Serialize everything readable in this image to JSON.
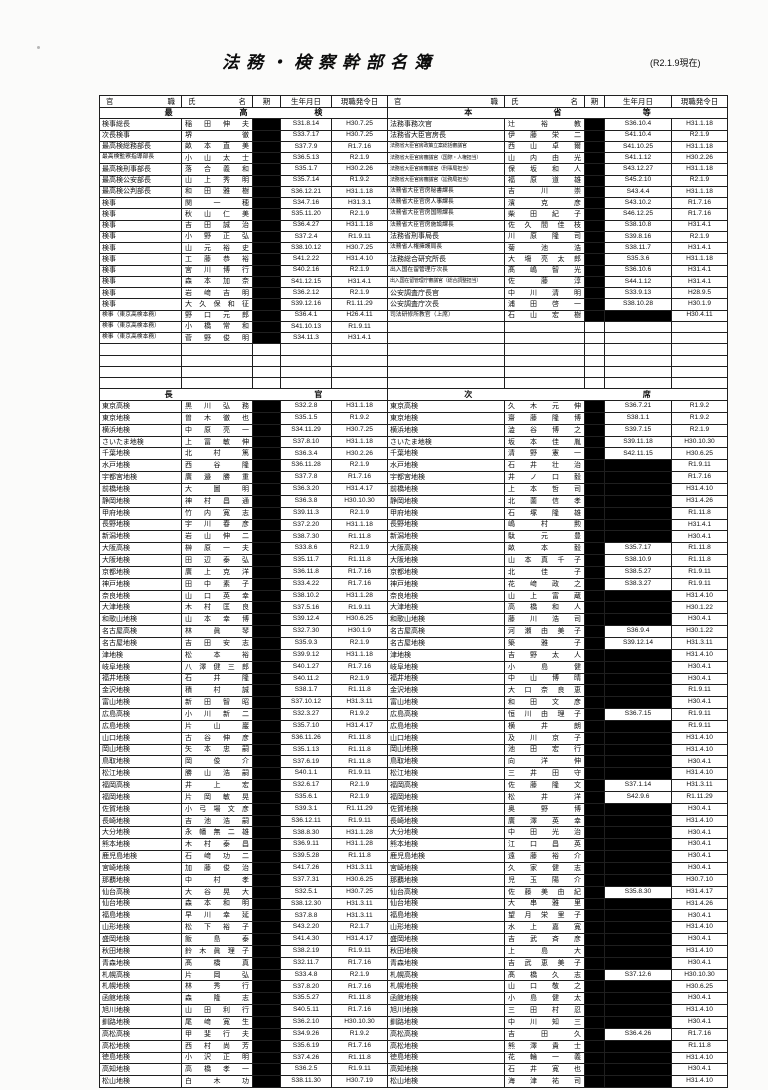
{
  "page": {
    "title": "法務・検察幹部名簿",
    "as_of": "(R2.1.9現在)"
  },
  "table": {
    "column_headers": [
      "官職",
      "氏名",
      "期",
      "生年月日",
      "現職発令日"
    ],
    "redaction_color": "#000000",
    "sections": [
      {
        "left_heading": "最高検",
        "right_heading": "本省等",
        "empty_rows": 4,
        "left_rows": [
          [
            "検事総長",
            "稲田伸夫",
            "S31.8.14",
            "H30.7.25"
          ],
          [
            "次長検事",
            "堺徹",
            "S33.7.17",
            "H30.7.25"
          ],
          [
            "最高検総務部長",
            "畝本直美",
            "S37.7.9",
            "R1.7.16"
          ],
          [
            "最高検監察指導部長",
            "小山太士",
            "S36.5.13",
            "R2.1.9"
          ],
          [
            "最高検刑事部長",
            "落合義和",
            "S35.1.7",
            "H30.2.26"
          ],
          [
            "最高検公安部長",
            "山上秀明",
            "S35.7.14",
            "R1.9.2"
          ],
          [
            "最高検公判部長",
            "和田雅樹",
            "S36.12.21",
            "H31.1.18"
          ],
          [
            "検事",
            "関一穂",
            "S34.7.16",
            "H31.3.1"
          ],
          [
            "検事",
            "秋山仁美",
            "S35.11.20",
            "R2.1.9"
          ],
          [
            "検事",
            "吉田誠治",
            "S36.4.27",
            "H31.1.18"
          ],
          [
            "検事",
            "小野正弘",
            "S37.2.4",
            "R1.9.11"
          ],
          [
            "検事",
            "山元裕史",
            "S38.10.12",
            "H30.7.25"
          ],
          [
            "検事",
            "工藤恭裕",
            "S41.2.22",
            "H31.4.10"
          ],
          [
            "検事",
            "宮川博行",
            "S40.2.16",
            "R2.1.9"
          ],
          [
            "検事",
            "森本加奈",
            "S41.12.15",
            "H31.4.1"
          ],
          [
            "検事",
            "岩﨑吉明",
            "S36.2.12",
            "R2.1.9"
          ],
          [
            "検事",
            "大久保和征",
            "S39.12.16",
            "R1.11.29"
          ],
          [
            "検事（東京高検本務）",
            "野口元郎",
            "S36.4.1",
            "H26.4.11"
          ],
          [
            "検事（東京高検本務）",
            "小橋常和",
            "S41.10.13",
            "R1.9.11"
          ],
          [
            "検事（東京高検本務）",
            "菅野俊明",
            "S34.11.3",
            "H31.4.1"
          ]
        ],
        "right_rows": [
          [
            "法務事務次官",
            "辻裕教",
            "S36.10.4",
            "H31.1.18"
          ],
          [
            "法務省大臣官房長",
            "伊藤栄二",
            "S41.10.4",
            "R2.1.9"
          ],
          [
            "法務省大臣官房政策立案総括審議官",
            "西山卓爾",
            "S41.10.25",
            "H31.1.18"
          ],
          [
            "法務省大臣官房審議官（国際・人権担当）",
            "山内由光",
            "S41.1.12",
            "H30.2.26"
          ],
          [
            "法務省大臣官房審議官（刑事局担当）",
            "保坂和人",
            "S43.12.27",
            "H31.1.18"
          ],
          [
            "法務省大臣官房審議官（訟務局担当）",
            "福原道雄",
            "S45.2.10",
            "R2.1.9"
          ],
          [
            "法務省大臣官房秘書課長",
            "吉川崇",
            "S43.4.4",
            "H31.1.18"
          ],
          [
            "法務省大臣官房人事課長",
            "濱克彦",
            "S43.10.2",
            "R1.7.16"
          ],
          [
            "法務省大臣官房国際課長",
            "柴田紀子",
            "S46.12.25",
            "R1.7.16"
          ],
          [
            "法務省大臣官房施設課長",
            "佐久間佳枝",
            "S38.10.8",
            "H31.4.1"
          ],
          [
            "法務省刑事局長",
            "川原隆司",
            "S39.8.16",
            "R2.1.9"
          ],
          [
            "法務省人権擁護局長",
            "菊池浩",
            "S38.11.7",
            "H31.4.1"
          ],
          [
            "法務総合研究所長",
            "大塲亮太郎",
            "S35.3.6",
            "H31.1.18"
          ],
          [
            "出入国在留管理庁次長",
            "髙嶋智光",
            "S36.10.6",
            "H31.4.1"
          ],
          [
            "出入国在留管理庁審議官（総合調整担当）",
            "佐藤淳",
            "S44.1.12",
            "H31.4.1"
          ],
          [
            "公安調査庁長官",
            "中川清明",
            "S33.9.13",
            "H28.9.5"
          ],
          [
            "公安調査庁次長",
            "浦田啓一",
            "S38.10.28",
            "H30.1.9"
          ],
          [
            "司法研修所教官（上席）",
            "石山宏樹",
            "",
            "H30.4.11"
          ]
        ]
      },
      {
        "left_heading": "長官",
        "right_heading": "次席",
        "empty_rows": 0,
        "left_rows": [
          [
            "東京高検",
            "黒川弘務",
            "S32.2.8",
            "H31.1.18"
          ],
          [
            "東京地検",
            "曽木徹也",
            "S35.1.5",
            "R1.9.2"
          ],
          [
            "横浜地検",
            "中原亮一",
            "S34.11.29",
            "H30.7.25"
          ],
          [
            "さいたま地検",
            "上冨敏伸",
            "S37.8.10",
            "H31.1.18"
          ],
          [
            "千葉地検",
            "北村篤",
            "S36.3.4",
            "H30.2.26"
          ],
          [
            "水戸地検",
            "西谷隆",
            "S36.11.28",
            "R2.1.9"
          ],
          [
            "宇都宮地検",
            "廣邉勝重",
            "S37.7.8",
            "R1.7.16"
          ],
          [
            "前橋地検",
            "大圖明",
            "S36.3.20",
            "H31.4.17"
          ],
          [
            "静岡地検",
            "神村昌通",
            "S36.3.8",
            "H30.10.30"
          ],
          [
            "甲府地検",
            "竹内寛志",
            "S39.11.3",
            "R2.1.9"
          ],
          [
            "長野地検",
            "宇川春彦",
            "S37.2.20",
            "H31.1.18"
          ],
          [
            "新潟地検",
            "岩山伸二",
            "S38.7.30",
            "R1.11.8"
          ],
          [
            "大阪高検",
            "榊原一夫",
            "S33.8.6",
            "R2.1.9"
          ],
          [
            "大阪地検",
            "田辺泰弘",
            "S35.11.7",
            "R1.11.8"
          ],
          [
            "京都地検",
            "廣上克洋",
            "S36.11.8",
            "R1.7.16"
          ],
          [
            "神戸地検",
            "田中素子",
            "S33.4.22",
            "R1.7.16"
          ],
          [
            "奈良地検",
            "山口英幸",
            "S38.10.2",
            "H31.1.28"
          ],
          [
            "大津地検",
            "木村匡良",
            "S37.5.16",
            "R1.9.11"
          ],
          [
            "和歌山地検",
            "山本幸博",
            "S39.12.4",
            "H30.6.25"
          ],
          [
            "名古屋高検",
            "林眞琴",
            "S32.7.30",
            "H30.1.9"
          ],
          [
            "名古屋地検",
            "吉田安志",
            "S35.9.3",
            "R2.1.9"
          ],
          [
            "津地検",
            "松本裕",
            "S39.9.12",
            "H31.1.18"
          ],
          [
            "岐阜地検",
            "八澤健三郎",
            "S40.1.27",
            "R1.7.16"
          ],
          [
            "福井地検",
            "石井隆",
            "S40.11.2",
            "R2.1.9"
          ],
          [
            "金沢地検",
            "積村誠",
            "S38.1.7",
            "R1.11.8"
          ],
          [
            "富山地検",
            "新田智昭",
            "S37.10.12",
            "H31.3.11"
          ],
          [
            "広島高検",
            "小川新二",
            "S32.3.27",
            "R1.9.2"
          ],
          [
            "広島地検",
            "片山巖",
            "S35.7.10",
            "H31.4.17"
          ],
          [
            "山口地検",
            "古谷伸彦",
            "S36.11.26",
            "R1.11.8"
          ],
          [
            "岡山地検",
            "矢本忠嗣",
            "S35.1.13",
            "R1.11.8"
          ],
          [
            "鳥取地検",
            "岡俊介",
            "S37.6.19",
            "R1.11.8"
          ],
          [
            "松江地検",
            "勝山浩嗣",
            "S40.1.1",
            "R1.9.11"
          ],
          [
            "福岡高検",
            "井上宏",
            "S32.6.17",
            "R2.1.9"
          ],
          [
            "福岡地検",
            "片岡敏晃",
            "S35.6.1",
            "R2.1.9"
          ],
          [
            "佐賀地検",
            "小弓場文彦",
            "S39.3.1",
            "R1.11.29"
          ],
          [
            "長崎地検",
            "吉池浩嗣",
            "S36.12.11",
            "R1.9.11"
          ],
          [
            "大分地検",
            "永幡無二雄",
            "S38.8.30",
            "H31.1.28"
          ],
          [
            "熊本地検",
            "木村泰昌",
            "S36.9.11",
            "H31.1.28"
          ],
          [
            "鹿児島地検",
            "石﨑功二",
            "S39.5.28",
            "R1.11.8"
          ],
          [
            "宮崎地検",
            "加藤俊治",
            "S41.7.26",
            "H31.3.11"
          ],
          [
            "那覇地検",
            "中村孝",
            "S37.7.31",
            "H30.6.25"
          ],
          [
            "仙台高検",
            "大谷晃大",
            "S32.5.1",
            "H30.7.25"
          ],
          [
            "仙台地検",
            "森本和明",
            "S38.12.30",
            "H31.3.11"
          ],
          [
            "福島地検",
            "早川幸延",
            "S37.8.8",
            "H31.3.11"
          ],
          [
            "山形地検",
            "松下裕子",
            "S43.2.20",
            "R2.1.7"
          ],
          [
            "盛岡地検",
            "飯島泰",
            "S41.4.30",
            "H31.4.17"
          ],
          [
            "秋田地検",
            "鈴木眞理子",
            "S38.2.19",
            "R1.9.11"
          ],
          [
            "青森地検",
            "髙橋真",
            "S32.11.7",
            "R1.7.16"
          ],
          [
            "札幌高検",
            "片岡弘",
            "S33.4.8",
            "R2.1.9"
          ],
          [
            "札幌地検",
            "林秀行",
            "S37.8.20",
            "R1.7.16"
          ],
          [
            "函館地検",
            "森隆志",
            "S35.5.27",
            "R1.11.8"
          ],
          [
            "旭川地検",
            "山田利行",
            "S40.5.11",
            "R1.7.16"
          ],
          [
            "釧路地検",
            "尾﨑寛生",
            "S36.2.10",
            "H30.10.30"
          ],
          [
            "高松高検",
            "甲斐行夫",
            "S34.9.26",
            "R1.9.2"
          ],
          [
            "高松地検",
            "西村尚芳",
            "S35.6.19",
            "R1.7.16"
          ],
          [
            "徳島地検",
            "小沢正明",
            "S37.4.26",
            "R1.11.8"
          ],
          [
            "高知地検",
            "高橋孝一",
            "S36.2.5",
            "R1.9.11"
          ],
          [
            "松山地検",
            "白木功",
            "S38.11.30",
            "H30.7.19"
          ]
        ],
        "right_rows": [
          [
            "東京高検",
            "久木元伸",
            "S36.7.21",
            "R1.9.2"
          ],
          [
            "東京地検",
            "齋藤隆博",
            "S38.1.1",
            "R1.9.2"
          ],
          [
            "横浜地検",
            "澁谷博之",
            "S39.7.15",
            "R2.1.9"
          ],
          [
            "さいたま地検",
            "坂本佳胤",
            "S39.11.18",
            "H30.10.30"
          ],
          [
            "千葉地検",
            "清野憲一",
            "S42.11.15",
            "H30.6.25"
          ],
          [
            "水戸地検",
            "石井壮治",
            "",
            "R1.9.11"
          ],
          [
            "宇都宮地検",
            "井ノ口毅",
            "",
            "R1.7.16"
          ],
          [
            "前橋地検",
            "上本哲司",
            "",
            "H31.4.10"
          ],
          [
            "静岡地検",
            "北薗信孝",
            "",
            "H31.4.26"
          ],
          [
            "甲府地検",
            "石塚隆雄",
            "",
            "R1.11.8"
          ],
          [
            "長野地検",
            "嶋村勲",
            "",
            "H31.4.1"
          ],
          [
            "新潟地検",
            "駄元豊",
            "",
            "H30.4.1"
          ],
          [
            "大阪高検",
            "畝本毅",
            "S35.7.17",
            "R1.11.8"
          ],
          [
            "大阪地検",
            "山本真千子",
            "S38.10.9",
            "R1.11.8"
          ],
          [
            "京都地検",
            "北佳子",
            "S38.5.27",
            "R1.9.11"
          ],
          [
            "神戸地検",
            "花﨑政之",
            "S38.3.27",
            "R1.9.11"
          ],
          [
            "奈良地検",
            "山上富蔵",
            "",
            "H31.4.10"
          ],
          [
            "大津地検",
            "高橋和人",
            "",
            "H30.1.22"
          ],
          [
            "和歌山地検",
            "藤川浩司",
            "",
            "H30.4.1"
          ],
          [
            "名古屋高検",
            "河瀬由美子",
            "S36.9.4",
            "H30.1.22"
          ],
          [
            "名古屋地検",
            "築雅子",
            "S39.12.14",
            "H31.3.11"
          ],
          [
            "津地検",
            "吉野太人",
            "",
            "H31.4.10"
          ],
          [
            "岐阜地検",
            "小島健",
            "",
            "H30.4.1"
          ],
          [
            "福井地検",
            "中山博晴",
            "",
            "H30.4.1"
          ],
          [
            "金沢地検",
            "大口奈良恵",
            "",
            "R1.9.11"
          ],
          [
            "富山地検",
            "和田文彦",
            "",
            "H30.4.1"
          ],
          [
            "広島高検",
            "恒川由理子",
            "S36.7.15",
            "R1.9.11"
          ],
          [
            "広島地検",
            "横井朗",
            "",
            "R1.9.11"
          ],
          [
            "山口地検",
            "及川京子",
            "",
            "H31.4.10"
          ],
          [
            "岡山地検",
            "池田宏行",
            "",
            "H31.4.10"
          ],
          [
            "鳥取地検",
            "向洋伸",
            "",
            "H30.4.1"
          ],
          [
            "松江地検",
            "三井田守",
            "",
            "H31.4.10"
          ],
          [
            "福岡高検",
            "佐藤隆文",
            "S37.1.14",
            "H31.3.11"
          ],
          [
            "福岡地検",
            "松井洋",
            "S42.9.6",
            "R1.11.29"
          ],
          [
            "佐賀地検",
            "奥野博",
            "",
            "H30.4.1"
          ],
          [
            "長崎地検",
            "廣澤英幸",
            "",
            "H31.4.10"
          ],
          [
            "大分地検",
            "中田光治",
            "",
            "H30.4.1"
          ],
          [
            "熊本地検",
            "江口昌英",
            "",
            "H30.4.1"
          ],
          [
            "鹿児島地検",
            "遠藤裕介",
            "",
            "H30.4.1"
          ],
          [
            "宮崎地検",
            "久家健志",
            "",
            "H30.4.1"
          ],
          [
            "那覇地検",
            "児玉陽介",
            "",
            "H30.7.10"
          ],
          [
            "仙台高検",
            "佐藤美由紀",
            "S35.8.30",
            "H31.4.17"
          ],
          [
            "仙台地検",
            "大串雅里",
            "",
            "H31.4.26"
          ],
          [
            "福島地検",
            "望月栄里子",
            "",
            "H30.4.1"
          ],
          [
            "山形地検",
            "水上嘉寛",
            "",
            "H31.4.10"
          ],
          [
            "盛岡地検",
            "吉武斉彦",
            "",
            "H30.4.1"
          ],
          [
            "秋田地検",
            "上島大",
            "",
            "H31.4.10"
          ],
          [
            "青森地検",
            "吉武恵美子",
            "",
            "H30.4.1"
          ],
          [
            "札幌高検",
            "髙橋久志",
            "S37.12.6",
            "H30.10.30"
          ],
          [
            "札幌地検",
            "山口敬之",
            "",
            "H30.6.25"
          ],
          [
            "函館地検",
            "小島健太",
            "",
            "H30.4.1"
          ],
          [
            "旭川地検",
            "三田村忍",
            "",
            "H31.4.10"
          ],
          [
            "釧路地検",
            "中川知三",
            "",
            "H30.4.1"
          ],
          [
            "高松高検",
            "吉田久",
            "S36.4.26",
            "R1.7.16"
          ],
          [
            "高松地検",
            "熊澤貴士",
            "",
            "R1.11.8"
          ],
          [
            "徳島地検",
            "花輪一義",
            "",
            "H31.4.10"
          ],
          [
            "高知地検",
            "石井寛也",
            "",
            "H30.4.1"
          ],
          [
            "松山地検",
            "海津祐司",
            "",
            "H31.4.10"
          ]
        ]
      }
    ]
  }
}
